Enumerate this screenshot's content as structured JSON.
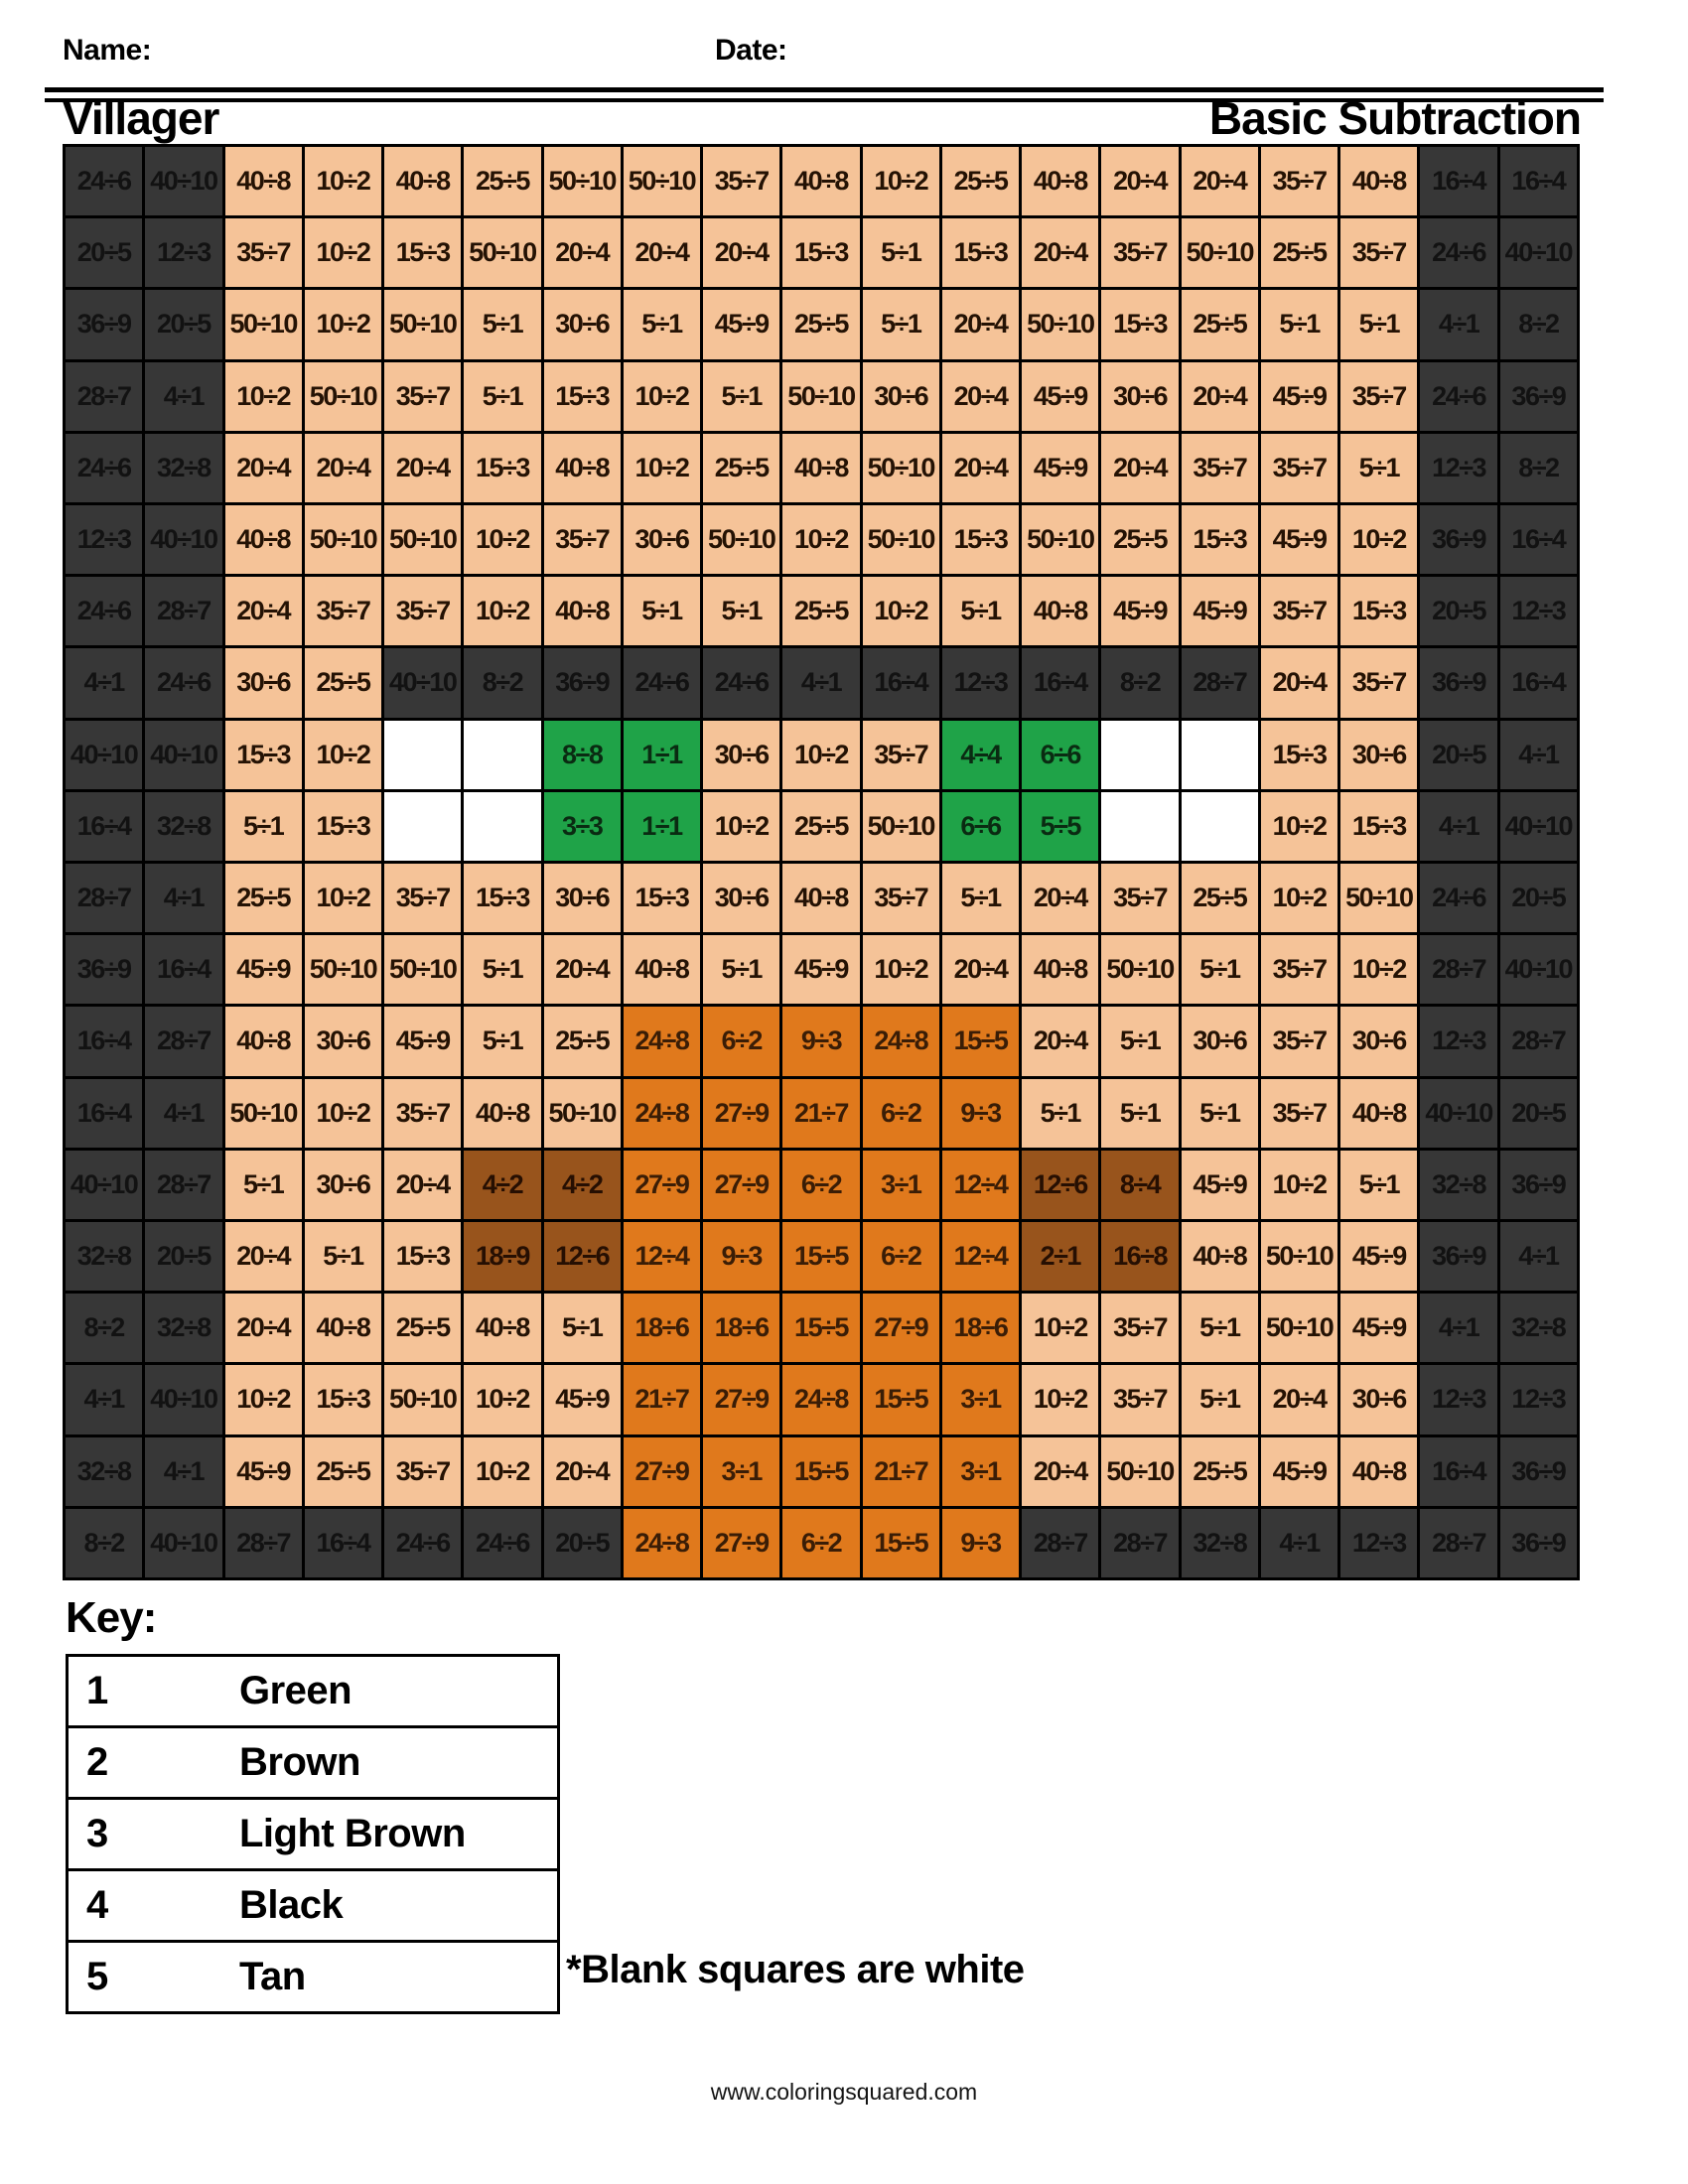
{
  "header": {
    "name_label": "Name:",
    "date_label": "Date:",
    "title": "Villager",
    "subtitle": "Basic Subtraction"
  },
  "grid": {
    "columns": 19,
    "rows_count": 20,
    "border_color": "#000000",
    "colors": {
      "K": {
        "name": "black",
        "bg": "#373737",
        "text": "#121212"
      },
      "T": {
        "name": "tan",
        "bg": "#f5c398",
        "text": "#241204"
      },
      "G": {
        "name": "green",
        "bg": "#1fa348",
        "text": "#0a2b12"
      },
      "O": {
        "name": "light-brown",
        "bg": "#e0791c",
        "text": "#3a1d06"
      },
      "B": {
        "name": "brown",
        "bg": "#98541c",
        "text": "#260f02"
      },
      "W": {
        "name": "white",
        "bg": "#ffffff",
        "text": "#000000"
      }
    },
    "rows": [
      [
        "24÷6|K",
        "40÷10|K",
        "40÷8|T",
        "10÷2|T",
        "40÷8|T",
        "25÷5|T",
        "50÷10|T",
        "50÷10|T",
        "35÷7|T",
        "40÷8|T",
        "10÷2|T",
        "25÷5|T",
        "40÷8|T",
        "20÷4|T",
        "20÷4|T",
        "35÷7|T",
        "40÷8|T",
        "16÷4|K",
        "16÷4|K"
      ],
      [
        "20÷5|K",
        "12÷3|K",
        "35÷7|T",
        "10÷2|T",
        "15÷3|T",
        "50÷10|T",
        "20÷4|T",
        "20÷4|T",
        "20÷4|T",
        "15÷3|T",
        "5÷1|T",
        "15÷3|T",
        "20÷4|T",
        "35÷7|T",
        "50÷10|T",
        "25÷5|T",
        "35÷7|T",
        "24÷6|K",
        "40÷10|K"
      ],
      [
        "36÷9|K",
        "20÷5|K",
        "50÷10|T",
        "10÷2|T",
        "50÷10|T",
        "5÷1|T",
        "30÷6|T",
        "5÷1|T",
        "45÷9|T",
        "25÷5|T",
        "5÷1|T",
        "20÷4|T",
        "50÷10|T",
        "15÷3|T",
        "25÷5|T",
        "5÷1|T",
        "5÷1|T",
        "4÷1|K",
        "8÷2|K"
      ],
      [
        "28÷7|K",
        "4÷1|K",
        "10÷2|T",
        "50÷10|T",
        "35÷7|T",
        "5÷1|T",
        "15÷3|T",
        "10÷2|T",
        "5÷1|T",
        "50÷10|T",
        "30÷6|T",
        "20÷4|T",
        "45÷9|T",
        "30÷6|T",
        "20÷4|T",
        "45÷9|T",
        "35÷7|T",
        "24÷6|K",
        "36÷9|K"
      ],
      [
        "24÷6|K",
        "32÷8|K",
        "20÷4|T",
        "20÷4|T",
        "20÷4|T",
        "15÷3|T",
        "40÷8|T",
        "10÷2|T",
        "25÷5|T",
        "40÷8|T",
        "50÷10|T",
        "20÷4|T",
        "45÷9|T",
        "20÷4|T",
        "35÷7|T",
        "35÷7|T",
        "5÷1|T",
        "12÷3|K",
        "8÷2|K"
      ],
      [
        "12÷3|K",
        "40÷10|K",
        "40÷8|T",
        "50÷10|T",
        "50÷10|T",
        "10÷2|T",
        "35÷7|T",
        "30÷6|T",
        "50÷10|T",
        "10÷2|T",
        "50÷10|T",
        "15÷3|T",
        "50÷10|T",
        "25÷5|T",
        "15÷3|T",
        "45÷9|T",
        "10÷2|T",
        "36÷9|K",
        "16÷4|K"
      ],
      [
        "24÷6|K",
        "28÷7|K",
        "20÷4|T",
        "35÷7|T",
        "35÷7|T",
        "10÷2|T",
        "40÷8|T",
        "5÷1|T",
        "5÷1|T",
        "25÷5|T",
        "10÷2|T",
        "5÷1|T",
        "40÷8|T",
        "45÷9|T",
        "45÷9|T",
        "35÷7|T",
        "15÷3|T",
        "20÷5|K",
        "12÷3|K"
      ],
      [
        "4÷1|K",
        "24÷6|K",
        "30÷6|T",
        "25÷5|T",
        "40÷10|K",
        "8÷2|K",
        "36÷9|K",
        "24÷6|K",
        "24÷6|K",
        "4÷1|K",
        "16÷4|K",
        "12÷3|K",
        "16÷4|K",
        "8÷2|K",
        "28÷7|K",
        "20÷4|T",
        "35÷7|T",
        "36÷9|K",
        "16÷4|K"
      ],
      [
        "40÷10|K",
        "40÷10|K",
        "15÷3|T",
        "10÷2|T",
        "|W",
        "|W",
        "8÷8|G",
        "1÷1|G",
        "30÷6|T",
        "10÷2|T",
        "35÷7|T",
        "4÷4|G",
        "6÷6|G",
        "|W",
        "|W",
        "15÷3|T",
        "30÷6|T",
        "20÷5|K",
        "4÷1|K"
      ],
      [
        "16÷4|K",
        "32÷8|K",
        "5÷1|T",
        "15÷3|T",
        "|W",
        "|W",
        "3÷3|G",
        "1÷1|G",
        "10÷2|T",
        "25÷5|T",
        "50÷10|T",
        "6÷6|G",
        "5÷5|G",
        "|W",
        "|W",
        "10÷2|T",
        "15÷3|T",
        "4÷1|K",
        "40÷10|K"
      ],
      [
        "28÷7|K",
        "4÷1|K",
        "25÷5|T",
        "10÷2|T",
        "35÷7|T",
        "15÷3|T",
        "30÷6|T",
        "15÷3|T",
        "30÷6|T",
        "40÷8|T",
        "35÷7|T",
        "5÷1|T",
        "20÷4|T",
        "35÷7|T",
        "25÷5|T",
        "10÷2|T",
        "50÷10|T",
        "24÷6|K",
        "20÷5|K"
      ],
      [
        "36÷9|K",
        "16÷4|K",
        "45÷9|T",
        "50÷10|T",
        "50÷10|T",
        "5÷1|T",
        "20÷4|T",
        "40÷8|T",
        "5÷1|T",
        "45÷9|T",
        "10÷2|T",
        "20÷4|T",
        "40÷8|T",
        "50÷10|T",
        "5÷1|T",
        "35÷7|T",
        "10÷2|T",
        "28÷7|K",
        "40÷10|K"
      ],
      [
        "16÷4|K",
        "28÷7|K",
        "40÷8|T",
        "30÷6|T",
        "45÷9|T",
        "5÷1|T",
        "25÷5|T",
        "24÷8|O",
        "6÷2|O",
        "9÷3|O",
        "24÷8|O",
        "15÷5|O",
        "20÷4|T",
        "5÷1|T",
        "30÷6|T",
        "35÷7|T",
        "30÷6|T",
        "12÷3|K",
        "28÷7|K"
      ],
      [
        "16÷4|K",
        "4÷1|K",
        "50÷10|T",
        "10÷2|T",
        "35÷7|T",
        "40÷8|T",
        "50÷10|T",
        "24÷8|O",
        "27÷9|O",
        "21÷7|O",
        "6÷2|O",
        "9÷3|O",
        "5÷1|T",
        "5÷1|T",
        "5÷1|T",
        "35÷7|T",
        "40÷8|T",
        "40÷10|K",
        "20÷5|K"
      ],
      [
        "40÷10|K",
        "28÷7|K",
        "5÷1|T",
        "30÷6|T",
        "20÷4|T",
        "4÷2|B",
        "4÷2|B",
        "27÷9|O",
        "27÷9|O",
        "6÷2|O",
        "3÷1|O",
        "12÷4|O",
        "12÷6|B",
        "8÷4|B",
        "45÷9|T",
        "10÷2|T",
        "5÷1|T",
        "32÷8|K",
        "36÷9|K"
      ],
      [
        "32÷8|K",
        "20÷5|K",
        "20÷4|T",
        "5÷1|T",
        "15÷3|T",
        "18÷9|B",
        "12÷6|B",
        "12÷4|O",
        "9÷3|O",
        "15÷5|O",
        "6÷2|O",
        "12÷4|O",
        "2÷1|B",
        "16÷8|B",
        "40÷8|T",
        "50÷10|T",
        "45÷9|T",
        "36÷9|K",
        "4÷1|K"
      ],
      [
        "8÷2|K",
        "32÷8|K",
        "20÷4|T",
        "40÷8|T",
        "25÷5|T",
        "40÷8|T",
        "5÷1|T",
        "18÷6|O",
        "18÷6|O",
        "15÷5|O",
        "27÷9|O",
        "18÷6|O",
        "10÷2|T",
        "35÷7|T",
        "5÷1|T",
        "50÷10|T",
        "45÷9|T",
        "4÷1|K",
        "32÷8|K"
      ],
      [
        "4÷1|K",
        "40÷10|K",
        "10÷2|T",
        "15÷3|T",
        "50÷10|T",
        "10÷2|T",
        "45÷9|T",
        "21÷7|O",
        "27÷9|O",
        "24÷8|O",
        "15÷5|O",
        "3÷1|O",
        "10÷2|T",
        "35÷7|T",
        "5÷1|T",
        "20÷4|T",
        "30÷6|T",
        "12÷3|K",
        "12÷3|K"
      ],
      [
        "32÷8|K",
        "4÷1|K",
        "45÷9|T",
        "25÷5|T",
        "35÷7|T",
        "10÷2|T",
        "20÷4|T",
        "27÷9|O",
        "3÷1|O",
        "15÷5|O",
        "21÷7|O",
        "3÷1|O",
        "20÷4|T",
        "50÷10|T",
        "25÷5|T",
        "45÷9|T",
        "40÷8|T",
        "16÷4|K",
        "36÷9|K"
      ],
      [
        "8÷2|K",
        "40÷10|K",
        "28÷7|K",
        "16÷4|K",
        "24÷6|K",
        "24÷6|K",
        "20÷5|K",
        "24÷8|O",
        "27÷9|O",
        "6÷2|O",
        "15÷5|O",
        "9÷3|O",
        "28÷7|K",
        "28÷7|K",
        "32÷8|K",
        "4÷1|K",
        "12÷3|K",
        "28÷7|K",
        "36÷9|K"
      ]
    ]
  },
  "key": {
    "heading": "Key:",
    "rows": [
      {
        "num": "1",
        "color": "Green"
      },
      {
        "num": "2",
        "color": "Brown"
      },
      {
        "num": "3",
        "color": "Light Brown"
      },
      {
        "num": "4",
        "color": "Black"
      },
      {
        "num": "5",
        "color": "Tan"
      }
    ],
    "note": "*Blank squares are white"
  },
  "footer": {
    "website": "www.coloringsquared.com"
  }
}
